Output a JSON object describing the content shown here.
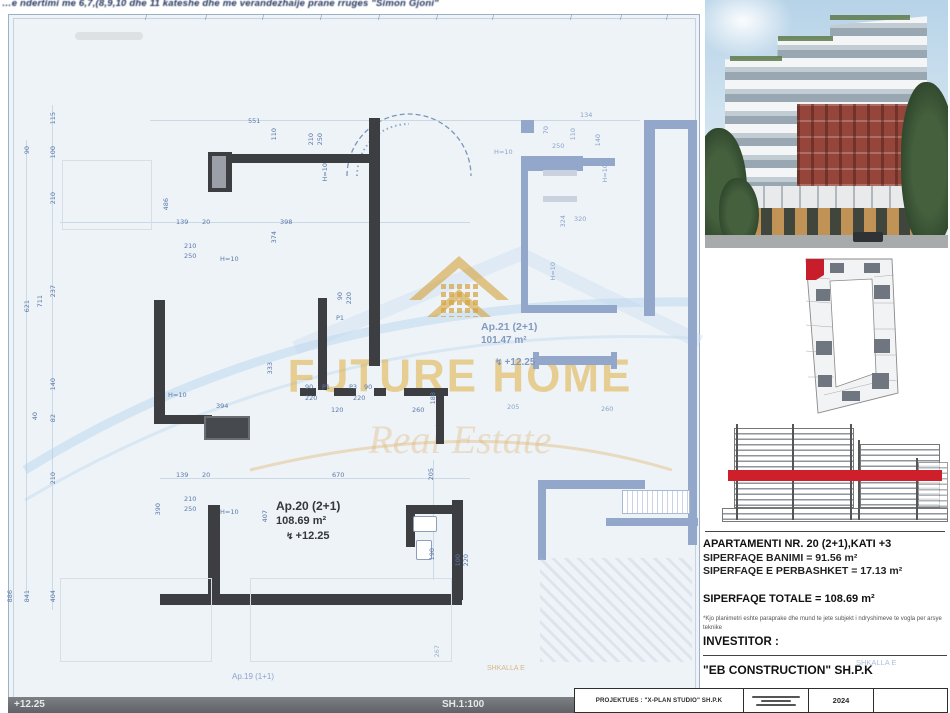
{
  "top_note": "…e ndertimi me 6,7,(8,9,10 dhe 11 kateshe dhe me verandezhaije prane rruges \"Simon Gjoni\"",
  "watermark": {
    "title": "FUTURE HOME",
    "subtitle": "Real Estate"
  },
  "plan": {
    "bar": {
      "level": "+12.25",
      "scale": "SH.1:100"
    },
    "ap20": {
      "name": "Ap.20 (2+1)",
      "area": "108.69 m²",
      "level": "+12.25"
    },
    "ap21": {
      "name": "Ap.21 (2+1)",
      "area": "101.47 m²",
      "level": "+12.25"
    },
    "ap19_label": "Ap.19 (1+1)",
    "stair_label": "SHKALLA E",
    "flash_glyph": "↯",
    "ticks": [
      145,
      205,
      262,
      320,
      378,
      436,
      492,
      570,
      620,
      666
    ],
    "walls": [
      {
        "x": 150,
        "y": 120,
        "w": 490,
        "h": 1,
        "c": "chain"
      },
      {
        "x": 60,
        "y": 222,
        "w": 410,
        "h": 1,
        "c": "chain"
      },
      {
        "x": 160,
        "y": 478,
        "w": 310,
        "h": 1,
        "c": "chain"
      },
      {
        "x": 52,
        "y": 105,
        "w": 1,
        "h": 505,
        "c": "chain"
      },
      {
        "x": 26,
        "y": 140,
        "w": 1,
        "h": 460,
        "c": "chain"
      },
      {
        "x": 433,
        "y": 460,
        "w": 1,
        "h": 120,
        "c": "chain"
      },
      {
        "x": 208,
        "y": 152,
        "w": 24,
        "h": 40,
        "c": "dark"
      },
      {
        "x": 212,
        "y": 156,
        "w": 14,
        "h": 32,
        "c": "grayin"
      },
      {
        "x": 230,
        "y": 154,
        "w": 148,
        "h": 9,
        "c": "dark"
      },
      {
        "x": 369,
        "y": 118,
        "w": 11,
        "h": 120,
        "c": "dark"
      },
      {
        "x": 369,
        "y": 236,
        "w": 11,
        "h": 130,
        "c": "dark"
      },
      {
        "x": 318,
        "y": 298,
        "w": 9,
        "h": 92,
        "c": "dark"
      },
      {
        "x": 154,
        "y": 300,
        "w": 11,
        "h": 122,
        "c": "dark"
      },
      {
        "x": 154,
        "y": 415,
        "w": 58,
        "h": 9,
        "c": "dark"
      },
      {
        "x": 204,
        "y": 416,
        "w": 46,
        "h": 24,
        "c": "dark2"
      },
      {
        "x": 208,
        "y": 505,
        "w": 12,
        "h": 100,
        "c": "dark"
      },
      {
        "x": 160,
        "y": 594,
        "w": 302,
        "h": 11,
        "c": "dark"
      },
      {
        "x": 452,
        "y": 500,
        "w": 11,
        "h": 100,
        "c": "dark"
      },
      {
        "x": 406,
        "y": 505,
        "w": 48,
        "h": 9,
        "c": "dark"
      },
      {
        "x": 406,
        "y": 505,
        "w": 9,
        "h": 42,
        "c": "dark"
      },
      {
        "x": 300,
        "y": 388,
        "w": 16,
        "h": 8,
        "c": "dark"
      },
      {
        "x": 334,
        "y": 388,
        "w": 22,
        "h": 8,
        "c": "dark"
      },
      {
        "x": 374,
        "y": 388,
        "w": 12,
        "h": 8,
        "c": "dark"
      },
      {
        "x": 404,
        "y": 388,
        "w": 44,
        "h": 8,
        "c": "dark"
      },
      {
        "x": 436,
        "y": 390,
        "w": 8,
        "h": 54,
        "c": "dark"
      },
      {
        "x": 521,
        "y": 120,
        "w": 13,
        "h": 13,
        "c": "nb"
      },
      {
        "x": 521,
        "y": 156,
        "w": 62,
        "h": 15,
        "c": "nb"
      },
      {
        "x": 583,
        "y": 158,
        "w": 32,
        "h": 8,
        "c": "nb"
      },
      {
        "x": 644,
        "y": 120,
        "w": 11,
        "h": 196,
        "c": "nb"
      },
      {
        "x": 644,
        "y": 120,
        "w": 46,
        "h": 9,
        "c": "nb"
      },
      {
        "x": 688,
        "y": 120,
        "w": 9,
        "h": 425,
        "c": "nb"
      },
      {
        "x": 521,
        "y": 170,
        "w": 7,
        "h": 140,
        "c": "nb"
      },
      {
        "x": 521,
        "y": 305,
        "w": 96,
        "h": 8,
        "c": "nb"
      },
      {
        "x": 533,
        "y": 352,
        "w": 6,
        "h": 17,
        "c": "nb"
      },
      {
        "x": 611,
        "y": 352,
        "w": 6,
        "h": 17,
        "c": "nb"
      },
      {
        "x": 533,
        "y": 356,
        "w": 84,
        "h": 9,
        "c": "nb"
      },
      {
        "x": 545,
        "y": 480,
        "w": 100,
        "h": 9,
        "c": "nb"
      },
      {
        "x": 538,
        "y": 480,
        "w": 8,
        "h": 80,
        "c": "nb"
      },
      {
        "x": 606,
        "y": 518,
        "w": 92,
        "h": 8,
        "c": "nb"
      },
      {
        "x": 543,
        "y": 170,
        "w": 34,
        "h": 6,
        "c": "lg"
      },
      {
        "x": 543,
        "y": 196,
        "w": 34,
        "h": 6,
        "c": "lg"
      },
      {
        "x": 62,
        "y": 160,
        "w": 90,
        "h": 70,
        "c": "outline"
      },
      {
        "x": 60,
        "y": 578,
        "w": 152,
        "h": 84,
        "c": "outline"
      },
      {
        "x": 250,
        "y": 578,
        "w": 202,
        "h": 84,
        "c": "outline"
      },
      {
        "x": 622,
        "y": 490,
        "w": 68,
        "h": 24,
        "c": "rail"
      },
      {
        "x": 413,
        "y": 516,
        "w": 24,
        "h": 16,
        "c": "fix"
      },
      {
        "x": 416,
        "y": 540,
        "w": 16,
        "h": 20,
        "c": "fix"
      },
      {
        "x": 540,
        "y": 558,
        "w": 152,
        "h": 104,
        "c": "hatch"
      }
    ],
    "dims": [
      {
        "t": "115",
        "x": 50,
        "y": 112,
        "v": 1
      },
      {
        "t": "100",
        "x": 50,
        "y": 146,
        "v": 1
      },
      {
        "t": "210",
        "x": 50,
        "y": 192,
        "v": 1
      },
      {
        "t": "237",
        "x": 50,
        "y": 285,
        "v": 1
      },
      {
        "t": "140",
        "x": 50,
        "y": 378,
        "v": 1
      },
      {
        "t": "82",
        "x": 50,
        "y": 414,
        "v": 1
      },
      {
        "t": "210",
        "x": 50,
        "y": 472,
        "v": 1
      },
      {
        "t": "404",
        "x": 50,
        "y": 590,
        "v": 1
      },
      {
        "t": "90",
        "x": 24,
        "y": 146,
        "v": 1
      },
      {
        "t": "621",
        "x": 24,
        "y": 300,
        "v": 1
      },
      {
        "t": "841",
        "x": 24,
        "y": 590,
        "v": 1
      },
      {
        "t": "711",
        "x": 37,
        "y": 295,
        "v": 1
      },
      {
        "t": "886",
        "x": 7,
        "y": 590,
        "v": 1
      },
      {
        "t": "40",
        "x": 32,
        "y": 412,
        "v": 1
      },
      {
        "t": "551",
        "x": 248,
        "y": 118
      },
      {
        "t": "110",
        "x": 271,
        "y": 128,
        "v": 1
      },
      {
        "t": "210",
        "x": 308,
        "y": 133,
        "v": 1
      },
      {
        "t": "250",
        "x": 317,
        "y": 133,
        "v": 1
      },
      {
        "t": "H=10",
        "x": 322,
        "y": 163,
        "v": 1
      },
      {
        "t": "486",
        "x": 163,
        "y": 198,
        "v": 1
      },
      {
        "t": "139",
        "x": 176,
        "y": 219
      },
      {
        "t": "20",
        "x": 202,
        "y": 219
      },
      {
        "t": "398",
        "x": 280,
        "y": 219
      },
      {
        "t": "374",
        "x": 271,
        "y": 231,
        "v": 1
      },
      {
        "t": "210",
        "x": 184,
        "y": 243
      },
      {
        "t": "250",
        "x": 184,
        "y": 253
      },
      {
        "t": "H=10",
        "x": 220,
        "y": 256
      },
      {
        "t": "90",
        "x": 337,
        "y": 292,
        "v": 1
      },
      {
        "t": "220",
        "x": 346,
        "y": 292,
        "v": 1
      },
      {
        "t": "P1",
        "x": 336,
        "y": 315
      },
      {
        "t": "333",
        "x": 267,
        "y": 362,
        "v": 1
      },
      {
        "t": "H=10",
        "x": 168,
        "y": 392
      },
      {
        "t": "394",
        "x": 216,
        "y": 403
      },
      {
        "t": "90",
        "x": 305,
        "y": 384
      },
      {
        "t": "P1",
        "x": 322,
        "y": 384
      },
      {
        "t": "P3",
        "x": 349,
        "y": 384
      },
      {
        "t": "90",
        "x": 364,
        "y": 384
      },
      {
        "t": "220",
        "x": 305,
        "y": 395
      },
      {
        "t": "120",
        "x": 331,
        "y": 407
      },
      {
        "t": "220",
        "x": 353,
        "y": 395
      },
      {
        "t": "260",
        "x": 412,
        "y": 407
      },
      {
        "t": "188",
        "x": 430,
        "y": 392,
        "v": 1
      },
      {
        "t": "139",
        "x": 176,
        "y": 472
      },
      {
        "t": "20",
        "x": 202,
        "y": 472
      },
      {
        "t": "670",
        "x": 332,
        "y": 472
      },
      {
        "t": "205",
        "x": 428,
        "y": 468,
        "v": 1
      },
      {
        "t": "210",
        "x": 184,
        "y": 496
      },
      {
        "t": "250",
        "x": 184,
        "y": 506
      },
      {
        "t": "H=10",
        "x": 220,
        "y": 509
      },
      {
        "t": "390",
        "x": 155,
        "y": 503,
        "v": 1
      },
      {
        "t": "407",
        "x": 262,
        "y": 510,
        "v": 1
      },
      {
        "t": "190",
        "x": 429,
        "y": 548,
        "v": 1
      },
      {
        "t": "100",
        "x": 455,
        "y": 554,
        "v": 1
      },
      {
        "t": "220",
        "x": 463,
        "y": 554,
        "v": 1
      },
      {
        "t": "267",
        "x": 434,
        "y": 645,
        "v": 1,
        "f": 1
      },
      {
        "t": "H=10",
        "x": 494,
        "y": 149,
        "l": 1
      },
      {
        "t": "134",
        "x": 580,
        "y": 112,
        "l": 1
      },
      {
        "t": "110",
        "x": 570,
        "y": 128,
        "v": 1,
        "l": 1
      },
      {
        "t": "140",
        "x": 595,
        "y": 134,
        "v": 1,
        "l": 1
      },
      {
        "t": "250",
        "x": 552,
        "y": 143,
        "l": 1
      },
      {
        "t": "70",
        "x": 543,
        "y": 126,
        "v": 1,
        "l": 1
      },
      {
        "t": "H=10",
        "x": 602,
        "y": 164,
        "v": 1,
        "l": 1
      },
      {
        "t": "324",
        "x": 560,
        "y": 215,
        "v": 1,
        "l": 1
      },
      {
        "t": "320",
        "x": 574,
        "y": 216,
        "l": 1
      },
      {
        "t": "H=10",
        "x": 550,
        "y": 262,
        "v": 1,
        "l": 1
      },
      {
        "t": "205",
        "x": 507,
        "y": 404,
        "l": 1
      },
      {
        "t": "260",
        "x": 601,
        "y": 406,
        "l": 1
      }
    ]
  },
  "sidebar": {
    "title": "APARTAMENTI NR. 20 (2+1),KATI +3",
    "line1": "SIPERFAQE BANIMI = 91.56 m²",
    "line2": "SIPERFAQE E PERBASHKET = 17.13 m²",
    "total": "SIPERFAQE TOTALE = 108.69 m²",
    "note": "*Kjo planimetri eshte paraprake dhe mund te jete subjekt i ndryshimeve te vogla per arsye teknike",
    "investor_label": "INVESTITOR :",
    "investor_name": "\"EB CONSTRUCTION\" SH.P.K"
  },
  "titleblock": {
    "designer": "PROJEKTUES : \"X-PLAN STUDIO\" SH.P.K",
    "year": "2024"
  },
  "colors": {
    "accent_red": "#cf1f2a",
    "watermark_gold": "#d5a33f",
    "neighbor_blue": "#93a7cb",
    "wall_dark": "#3c3e42"
  }
}
